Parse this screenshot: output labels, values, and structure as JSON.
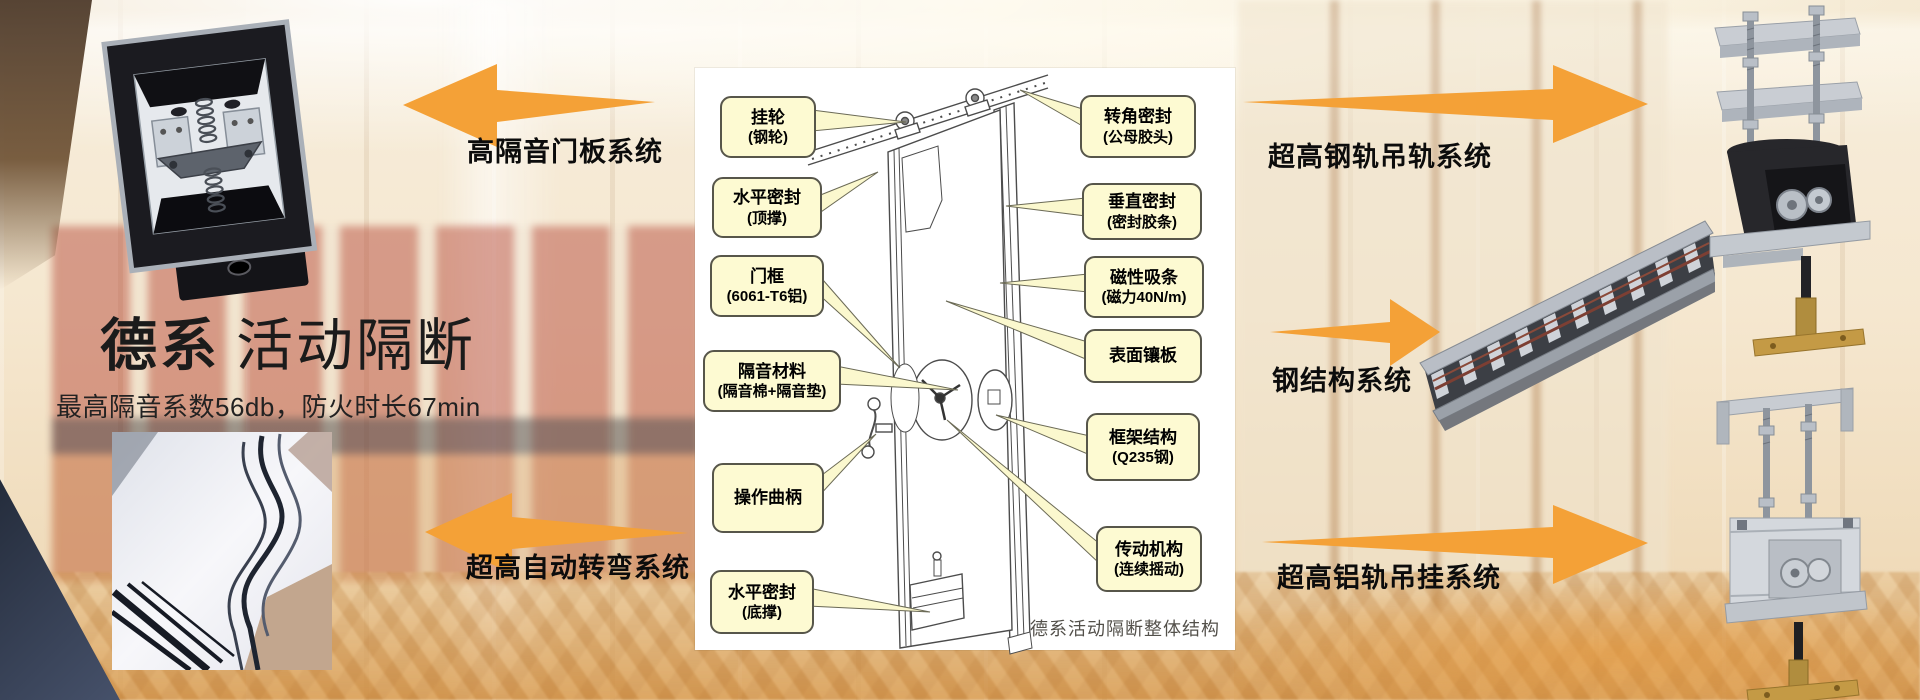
{
  "header": {
    "brand_bold": "德系",
    "brand_rest": "活动隔断",
    "subtitle": "最高隔音系数56db，防火时长67min"
  },
  "systems": {
    "door_panel": "高隔音门板系统",
    "auto_turning": "超高自动转弯系统",
    "steel_rail": "超高钢轨吊轨系统",
    "steel_structure": "钢结构系统",
    "aluminum_rail": "超高铝轨吊挂系统"
  },
  "diagram": {
    "caption": "德系活动隔断整体结构",
    "callouts": {
      "left": [
        {
          "title": "挂轮",
          "detail": "(钢轮)"
        },
        {
          "title": "水平密封",
          "detail": "(顶撑)"
        },
        {
          "title": "门框",
          "detail": "(6061-T6铝)"
        },
        {
          "title": "隔音材料",
          "detail": "(隔音棉+隔音垫)"
        },
        {
          "title": "操作曲柄",
          "detail": ""
        },
        {
          "title": "水平密封",
          "detail": "(底撑)"
        }
      ],
      "right": [
        {
          "title": "转角密封",
          "detail": "(公母胶头)"
        },
        {
          "title": "垂直密封",
          "detail": "(密封胶条)"
        },
        {
          "title": "磁性吸条",
          "detail": "(磁力40N/m)"
        },
        {
          "title": "表面镶板",
          "detail": ""
        },
        {
          "title": "框架结构",
          "detail": "(Q235钢)"
        },
        {
          "title": "传动机构",
          "detail": "(连续摇动)"
        }
      ]
    }
  },
  "colors": {
    "arrow_orange": "#F4A137",
    "callout_fill": "#FDFAD2",
    "callout_border": "#57564A",
    "red_wall": "#B2423 2",
    "carpet_gold": "#D5944 6"
  }
}
